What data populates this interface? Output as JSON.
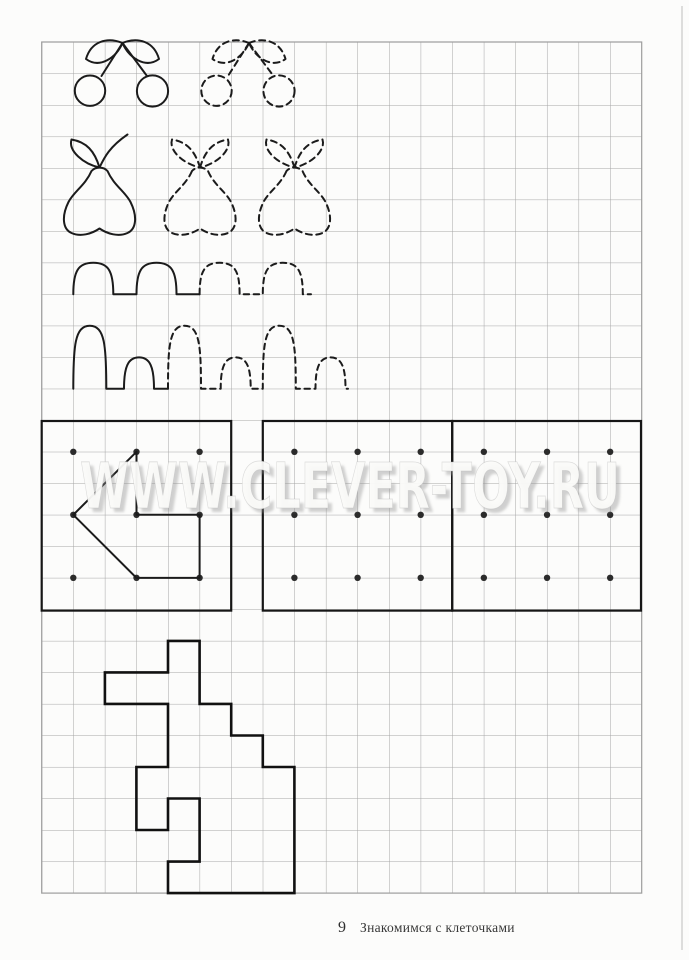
{
  "watermark": {
    "text": "WWW.CLEVER-TOY.RU"
  },
  "footer": {
    "page_number": "9",
    "title": "Знакомимся с клеточками"
  },
  "figures": {
    "row1": "cherries-solid-and-dashed-tracing",
    "row2": "pear-solid-and-two-dashed-tracings",
    "row3": "arch-wave-solid-then-dashed",
    "row4": "tall-and-small-arches-solid-then-dashed",
    "boxes": "left-arrow-on-dot-grid-plus-two-empty-dot-grids",
    "bottom": "key-outline-along-grid-lines"
  },
  "colors": {
    "paper": "#fcfcfb",
    "grid_line": "#a5a5a5",
    "ink": "#1b1b1b",
    "dot": "#2b2b2b",
    "watermark_fill": "#fbfbf9",
    "watermark_shadow": "#8e8e8e"
  }
}
